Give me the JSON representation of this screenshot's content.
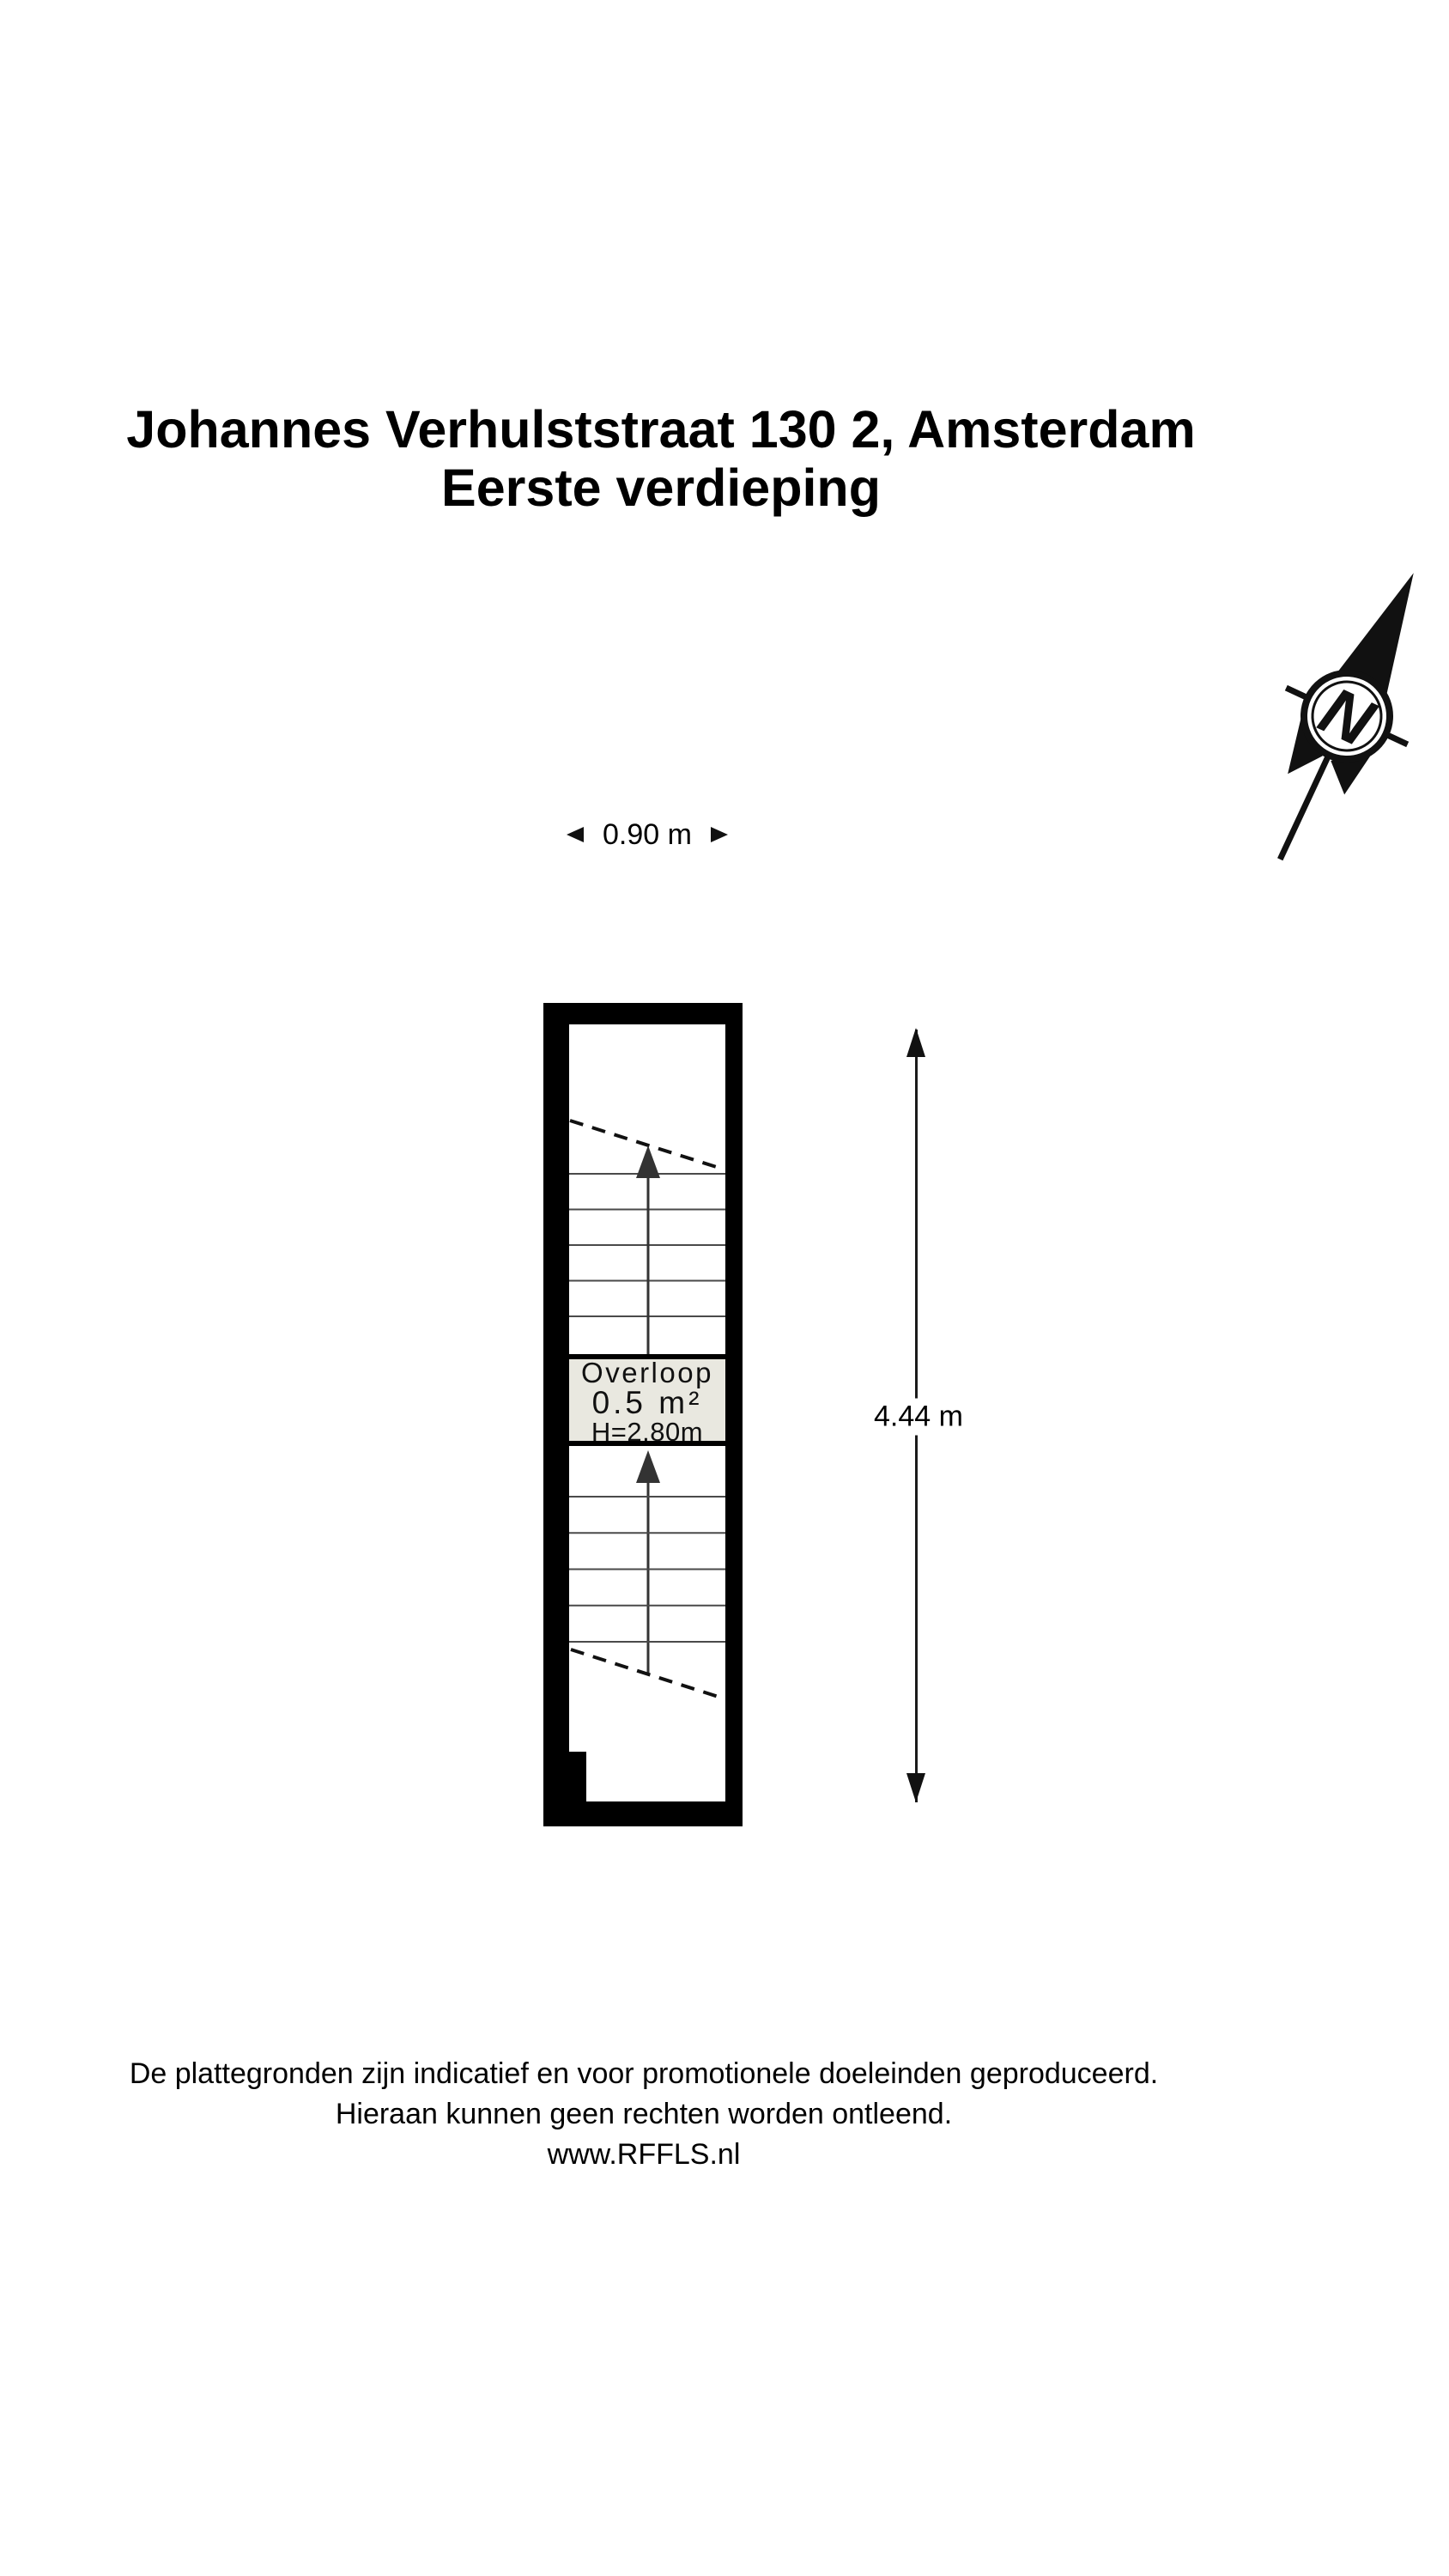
{
  "title": {
    "line1": "Johannes Verhulststraat 130 2, Amsterdam",
    "line2": "Eerste verdieping"
  },
  "compass": {
    "label": "N"
  },
  "dimensions": {
    "width": "0.90 m",
    "height": "4.44 m"
  },
  "room": {
    "name": "Overloop",
    "area": "0.5 m²",
    "ceiling_height": "H=2.80m"
  },
  "stairs": {
    "upper_treads": 5,
    "lower_treads": 5
  },
  "footer": {
    "lines": [
      "De plattegronden zijn indicatief en voor promotionele doeleinden geproduceerd.",
      "Hieraan kunnen geen rechten worden ontleend.",
      "www.RFFLS.nl"
    ]
  },
  "colors": {
    "wall": "#000000",
    "landing_fill": "#e9e8e0",
    "tread_line": "#4a4a4a",
    "stair_arrow": "#333333",
    "accent": "#111111",
    "background": "#ffffff"
  }
}
